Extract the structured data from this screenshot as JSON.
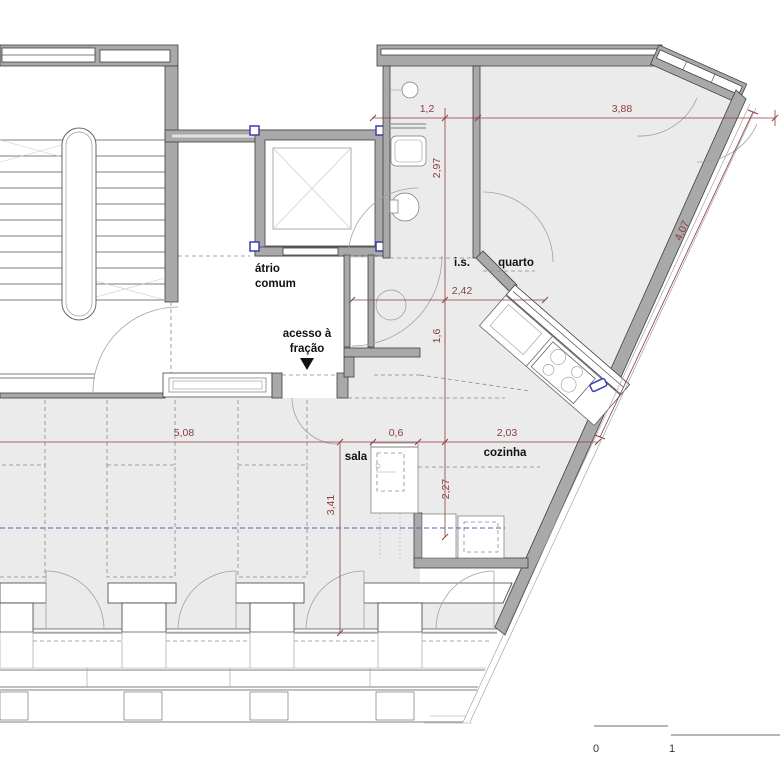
{
  "drawing": {
    "kind": "architectural floor plan",
    "rooms": {
      "atrio_line1": "átrio",
      "atrio_line2": "comum",
      "acesso_line1": "acesso à",
      "acesso_line2": "fração",
      "is": "i.s.",
      "quarto": "quarto",
      "sala": "sala",
      "cozinha": "cozinha"
    },
    "dimensions": [
      {
        "id": "is-width",
        "value": "1,2"
      },
      {
        "id": "quarto-width",
        "value": "3,88"
      },
      {
        "id": "is-depth",
        "value": "2,97"
      },
      {
        "id": "hall-width",
        "value": "2,42"
      },
      {
        "id": "hall-depth",
        "value": "1,6"
      },
      {
        "id": "quarto-diagonal",
        "value": "4,07"
      },
      {
        "id": "sala-width",
        "value": "5,08"
      },
      {
        "id": "cabinet-width",
        "value": "0,6"
      },
      {
        "id": "cozinha-width",
        "value": "2,03"
      },
      {
        "id": "sala-depth",
        "value": "3,41"
      },
      {
        "id": "cozinha-depth",
        "value": "2,27"
      }
    ],
    "scale_bar": {
      "start_label": "0",
      "end_label": "1"
    },
    "colors": {
      "dimension_red": "#8c3b40",
      "marker_blue": "#3d3db5",
      "room_fill": "#ebebeb",
      "wall_fill": "#a9a9a9",
      "wall_stroke": "#3f3f3f"
    }
  }
}
